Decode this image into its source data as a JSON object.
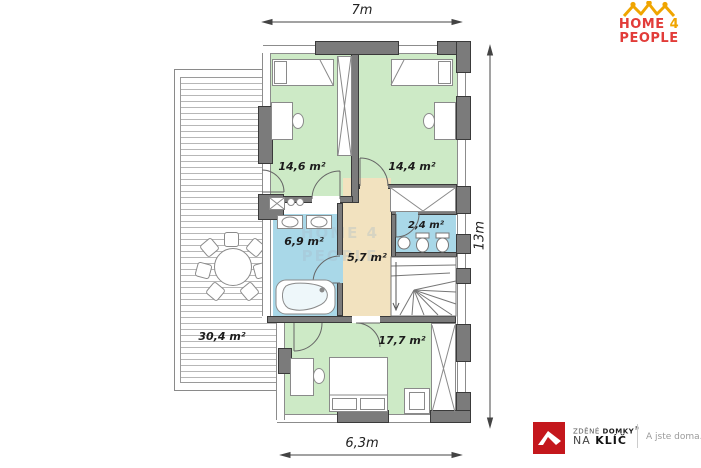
{
  "branding": {
    "home4people": {
      "word1": "HOME",
      "word2": "4",
      "word3": "PEOPLE",
      "text_color": "#e23c39",
      "accent_color": "#f0a500",
      "icon": "crown-of-people-icon"
    },
    "zdene_domky": {
      "line1_regular": "ZDĚNÉ ",
      "line1_bold": "DOMKY",
      "reg_mark": "®",
      "line2_regular": "NA ",
      "line2_bold": "KLÍČ",
      "tagline": "A jste doma.",
      "logo_color": "#c4171c",
      "icon": "roof-icon"
    }
  },
  "watermark": "HOME 4 PEOPLE",
  "dimensions": {
    "top": "7m",
    "right": "13m",
    "bottom": "6,3m"
  },
  "rooms": {
    "bedroom_top_left": {
      "area": "14,6 m²",
      "fill": "#cdeac6"
    },
    "bedroom_top_right": {
      "area": "14,4 m²",
      "fill": "#cdeac6"
    },
    "bathroom": {
      "area": "6,9 m²",
      "fill": "#a9d8e8"
    },
    "hallway": {
      "area": "5,7 m²",
      "fill": "#f2e2bf"
    },
    "wc": {
      "area": "2,4 m²",
      "fill": "#a9d8e8"
    },
    "bedroom_bottom": {
      "area": "17,7 m²",
      "fill": "#cdeac6"
    },
    "terrace": {
      "area": "30,4 m²",
      "fill": "#ffffff"
    }
  },
  "colors": {
    "wall_gray": "#7b7b7b",
    "line_dark": "#3a3a3a"
  }
}
